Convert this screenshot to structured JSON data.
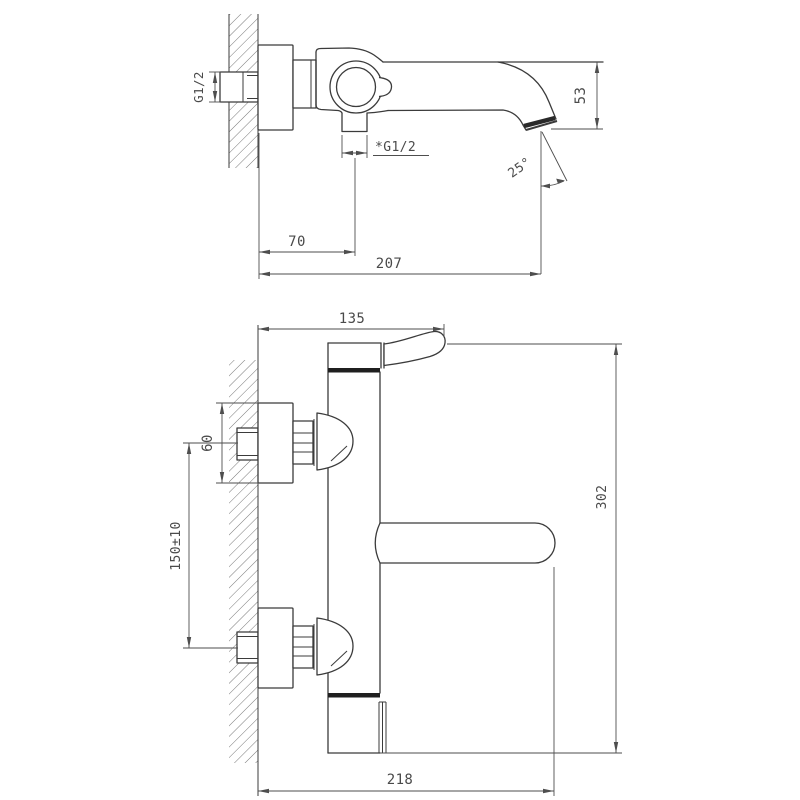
{
  "drawing": {
    "subject": "Wall-mounted bath mixer tap — dimensional technical drawing",
    "colors": {
      "line": "#3b3b3b",
      "dim": "#4e4e4e",
      "text": "#4a4a4a",
      "accent_dark": "#1f1f1f",
      "background": "#ffffff"
    },
    "views": {
      "side": {
        "label": "side profile view (spout)",
        "dims": {
          "inlet_thread": "G1/2",
          "spout_height": "53",
          "spray_angle": "25°",
          "hose_outlet_thread": "*G1/2",
          "outlet_offset": "70",
          "spout_reach": "207"
        }
      },
      "front": {
        "label": "front view (body and supplies)",
        "dims": {
          "handle_length": "135",
          "escutcheon_height": "60",
          "supply_centres": "150±10",
          "body_width": "302",
          "overall_depth": "218"
        }
      }
    }
  }
}
